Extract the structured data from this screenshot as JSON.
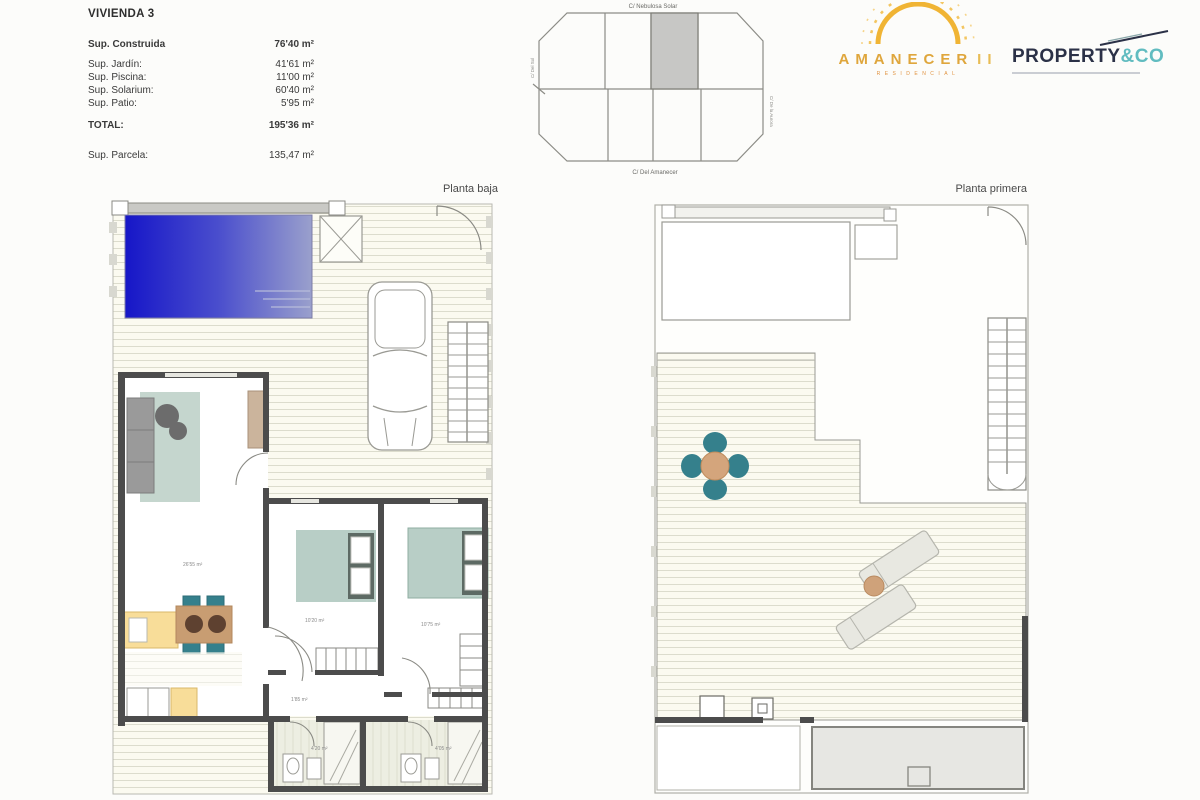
{
  "info": {
    "title": "VIVIENDA 3",
    "construida": {
      "label": "Sup. Construida",
      "value": "76'40 m²"
    },
    "rows": [
      {
        "label": "Sup. Jardín:",
        "value": "41'61 m²"
      },
      {
        "label": "Sup. Piscina:",
        "value": "11'00 m²"
      },
      {
        "label": "Sup. Solarium:",
        "value": "60'40 m²"
      },
      {
        "label": "Sup. Patio:",
        "value": "5'95 m²"
      }
    ],
    "total": {
      "label": "TOTAL:",
      "value": "195'36 m²"
    },
    "parcela": {
      "label": "Sup. Parcela:",
      "value": "135,47 m²"
    }
  },
  "site_plan": {
    "street_top": "C/ Nebulosa Solar",
    "street_bottom": "C/ Del Amanecer",
    "street_left": "C/ Del Sol",
    "street_right": "C/ De la Aurora"
  },
  "logos": {
    "amanecer": {
      "title": "AMANECER",
      "suffix": "II",
      "subtitle": "RESIDENCIAL"
    },
    "property": {
      "name": "PROPERTY",
      "suffix": "&CO"
    }
  },
  "plans": {
    "left": {
      "caption": "Planta baja",
      "labels": {
        "living": "26'55 m²",
        "bedroom1": "10'20 m²",
        "bedroom2": "10'75 m²",
        "hall": "1'85 m²",
        "bath1": "4'20 m²",
        "bath2": "4'05 m²"
      }
    },
    "right": {
      "caption": "Planta primera"
    }
  },
  "colors": {
    "pool_dark": "#1616c8",
    "pool_light": "#9aa0cc",
    "bed_green": "#b8cec6",
    "chair_teal": "#35808c",
    "table_tan": "#c89d72",
    "counter_yellow": "#f8dd99",
    "wall_dark": "#4c4c4c",
    "logo_gold": "#dfa63c",
    "logo_orange": "#e0923f",
    "logo_navy": "#2b3147",
    "logo_teal": "#61bcc0"
  }
}
